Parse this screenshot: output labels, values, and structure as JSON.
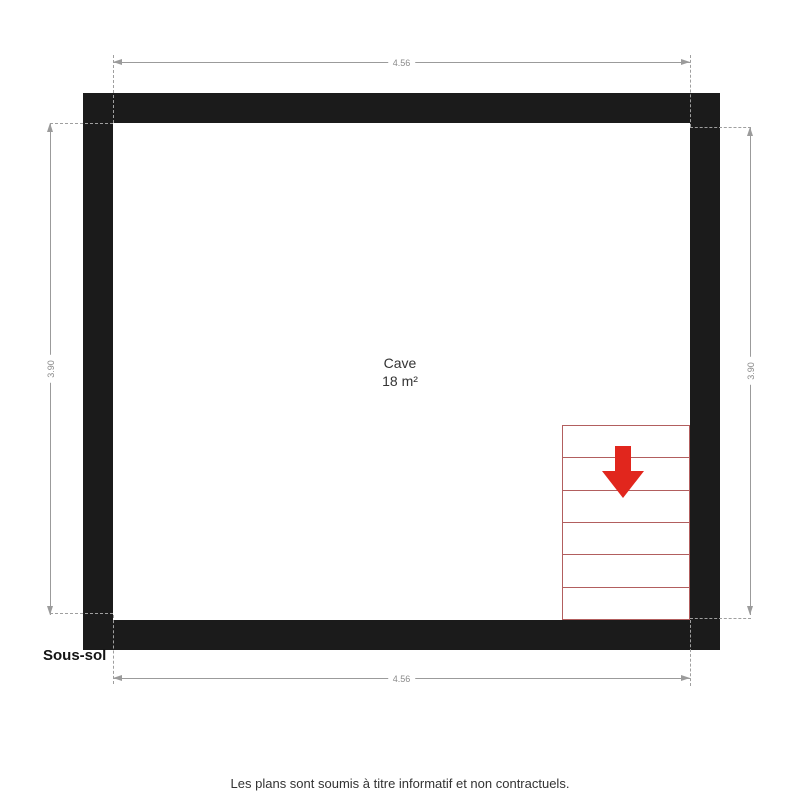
{
  "plan": {
    "floor_label": "Sous-sol",
    "room": {
      "name": "Cave",
      "area": "18 m²"
    },
    "dimensions": {
      "width_top": "4.56",
      "width_bottom": "4.56",
      "height_left": "3.90",
      "height_right": "3.90"
    },
    "stairs": {
      "treads": 6,
      "direction": "down"
    }
  },
  "footer": {
    "disclaimer": "Les plans sont soumis à titre informatif et non contractuels."
  },
  "colors": {
    "wall": "#1b1b1b",
    "dimension_line": "#9b9b9b",
    "stair_outline": "#b25e5e",
    "arrow_red": "#e1261d"
  }
}
